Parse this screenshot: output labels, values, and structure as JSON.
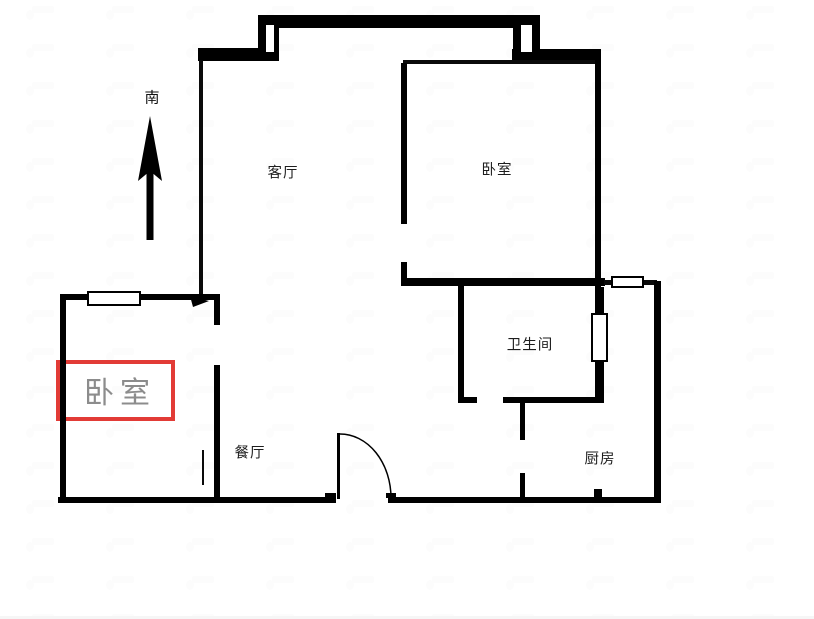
{
  "compass": {
    "label": "南"
  },
  "rooms": {
    "living_room": {
      "label": "客厅"
    },
    "bedroom_main": {
      "label": "卧室"
    },
    "bathroom": {
      "label": "卫生间"
    },
    "dining_room": {
      "label": "餐厅"
    },
    "kitchen": {
      "label": "厨房"
    }
  },
  "highlight": {
    "room_label": "卧室",
    "box_color": "#e23b36",
    "label_color": "#8c8c8c"
  },
  "colors": {
    "wall": "#000000",
    "background": "#ffffff",
    "label": "#1d1d1d"
  }
}
